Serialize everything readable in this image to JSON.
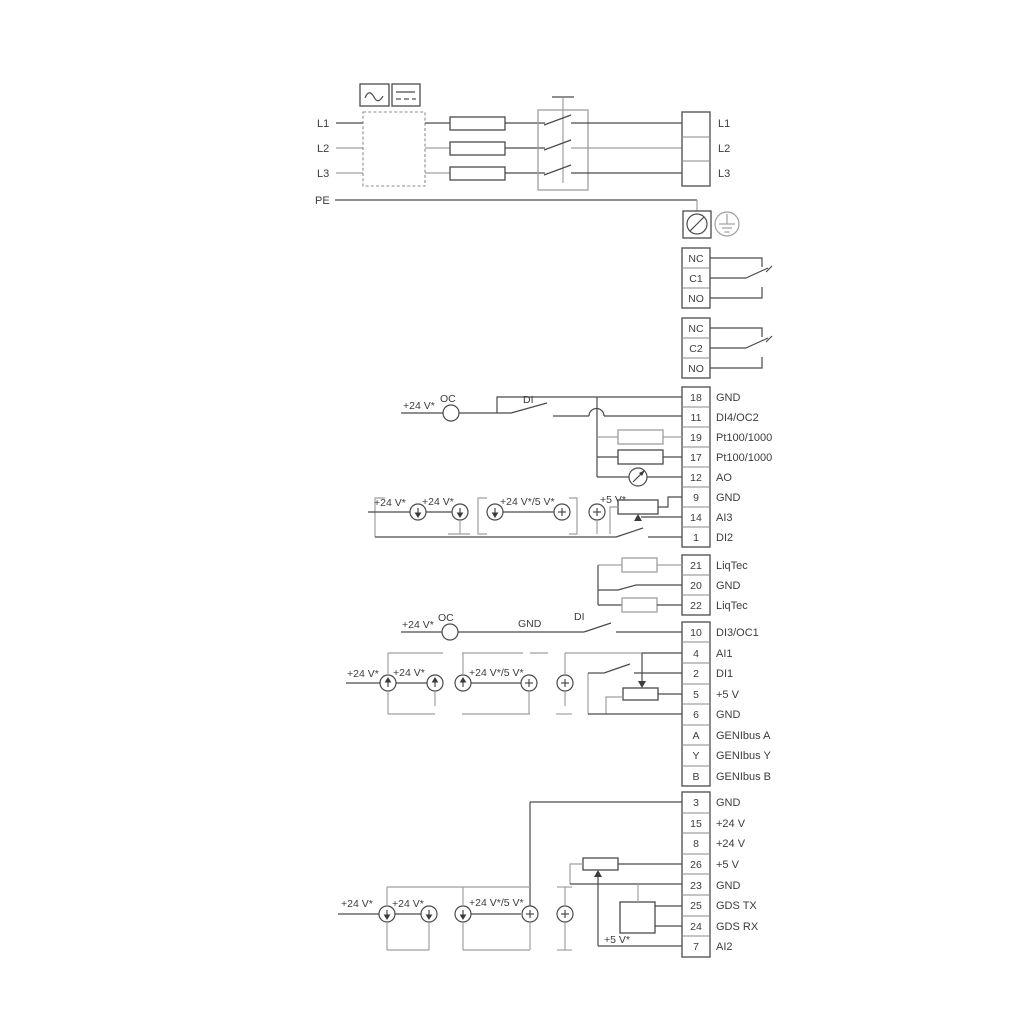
{
  "power": {
    "inputs": [
      "L1",
      "L2",
      "L3",
      "PE"
    ],
    "outputs": [
      "L1",
      "L2",
      "L3"
    ]
  },
  "relays": [
    [
      "NC",
      "C1",
      "NO"
    ],
    [
      "NC",
      "C2",
      "NO"
    ]
  ],
  "strip1": [
    {
      "n": "18",
      "t": "GND"
    },
    {
      "n": "11",
      "t": "DI4/OC2"
    },
    {
      "n": "19",
      "t": "Pt100/1000"
    },
    {
      "n": "17",
      "t": "Pt100/1000"
    },
    {
      "n": "12",
      "t": "AO"
    },
    {
      "n": "9",
      "t": "GND"
    },
    {
      "n": "14",
      "t": "AI3"
    },
    {
      "n": "1",
      "t": "DI2"
    }
  ],
  "strip2": [
    {
      "n": "21",
      "t": "LiqTec"
    },
    {
      "n": "20",
      "t": "GND"
    },
    {
      "n": "22",
      "t": "LiqTec"
    }
  ],
  "strip3": [
    {
      "n": "10",
      "t": "DI3/OC1"
    },
    {
      "n": "4",
      "t": "AI1"
    },
    {
      "n": "2",
      "t": "DI1"
    },
    {
      "n": "5",
      "t": "+5 V"
    },
    {
      "n": "6",
      "t": "GND"
    },
    {
      "n": "A",
      "t": "GENIbus A"
    },
    {
      "n": "Y",
      "t": "GENIbus Y"
    },
    {
      "n": "B",
      "t": "GENIbus B"
    }
  ],
  "strip4": [
    {
      "n": "3",
      "t": "GND"
    },
    {
      "n": "15",
      "t": "+24 V"
    },
    {
      "n": "8",
      "t": "+24 V"
    },
    {
      "n": "26",
      "t": "+5 V"
    },
    {
      "n": "23",
      "t": "GND"
    },
    {
      "n": "25",
      "t": "GDS TX"
    },
    {
      "n": "24",
      "t": "GDS RX"
    },
    {
      "n": "7",
      "t": "AI2"
    }
  ],
  "ann": {
    "v24": "+24 V*",
    "v24v5": "+24 V*/5 V*",
    "v5": "+5 V*",
    "oc": "OC",
    "di": "DI",
    "gnd": "GND"
  },
  "colors": {
    "wire": "#4a4a4a",
    "wire_light": "#9f9f9f",
    "background": "#ffffff"
  }
}
